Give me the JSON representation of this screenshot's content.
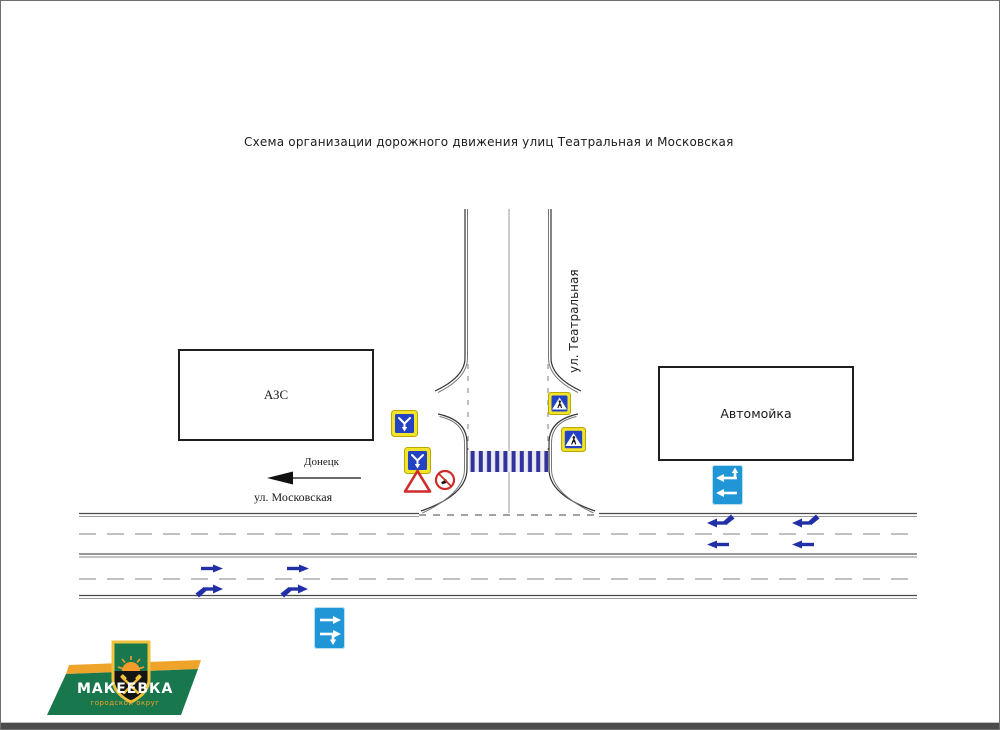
{
  "title": "Схема организации дорожного движения улиц Театральная и Московская",
  "streets": {
    "vertical_label": "ул. Театральная",
    "horizontal_label": "ул. Московская",
    "direction_city": "Донецк"
  },
  "buildings": {
    "left_label": "АЗС",
    "right_label": "Автомойка"
  },
  "signs": {
    "lane_direction_icon": "lane-direction-sign",
    "give_way_icon": "give-way-sign",
    "prohibition_icon": "prohibition-sign",
    "pedestrian_icon": "pedestrian-crossing-sign",
    "lanes_board_icon": "lanes-direction-board",
    "crosswalk_marking": "zebra-crossing"
  },
  "logo": {
    "city": "МАКЕЕВКА",
    "subtitle": "городской округ"
  },
  "colors": {
    "sign_blue": "#2443c4",
    "sign_yellow": "#f2e32b",
    "board_blue": "#2196d6",
    "arrow_navy": "#2230a8",
    "red": "#cf2b2b",
    "logo_green": "#19774d",
    "logo_orange": "#f0a32a",
    "zebra_navy": "#32329b"
  }
}
